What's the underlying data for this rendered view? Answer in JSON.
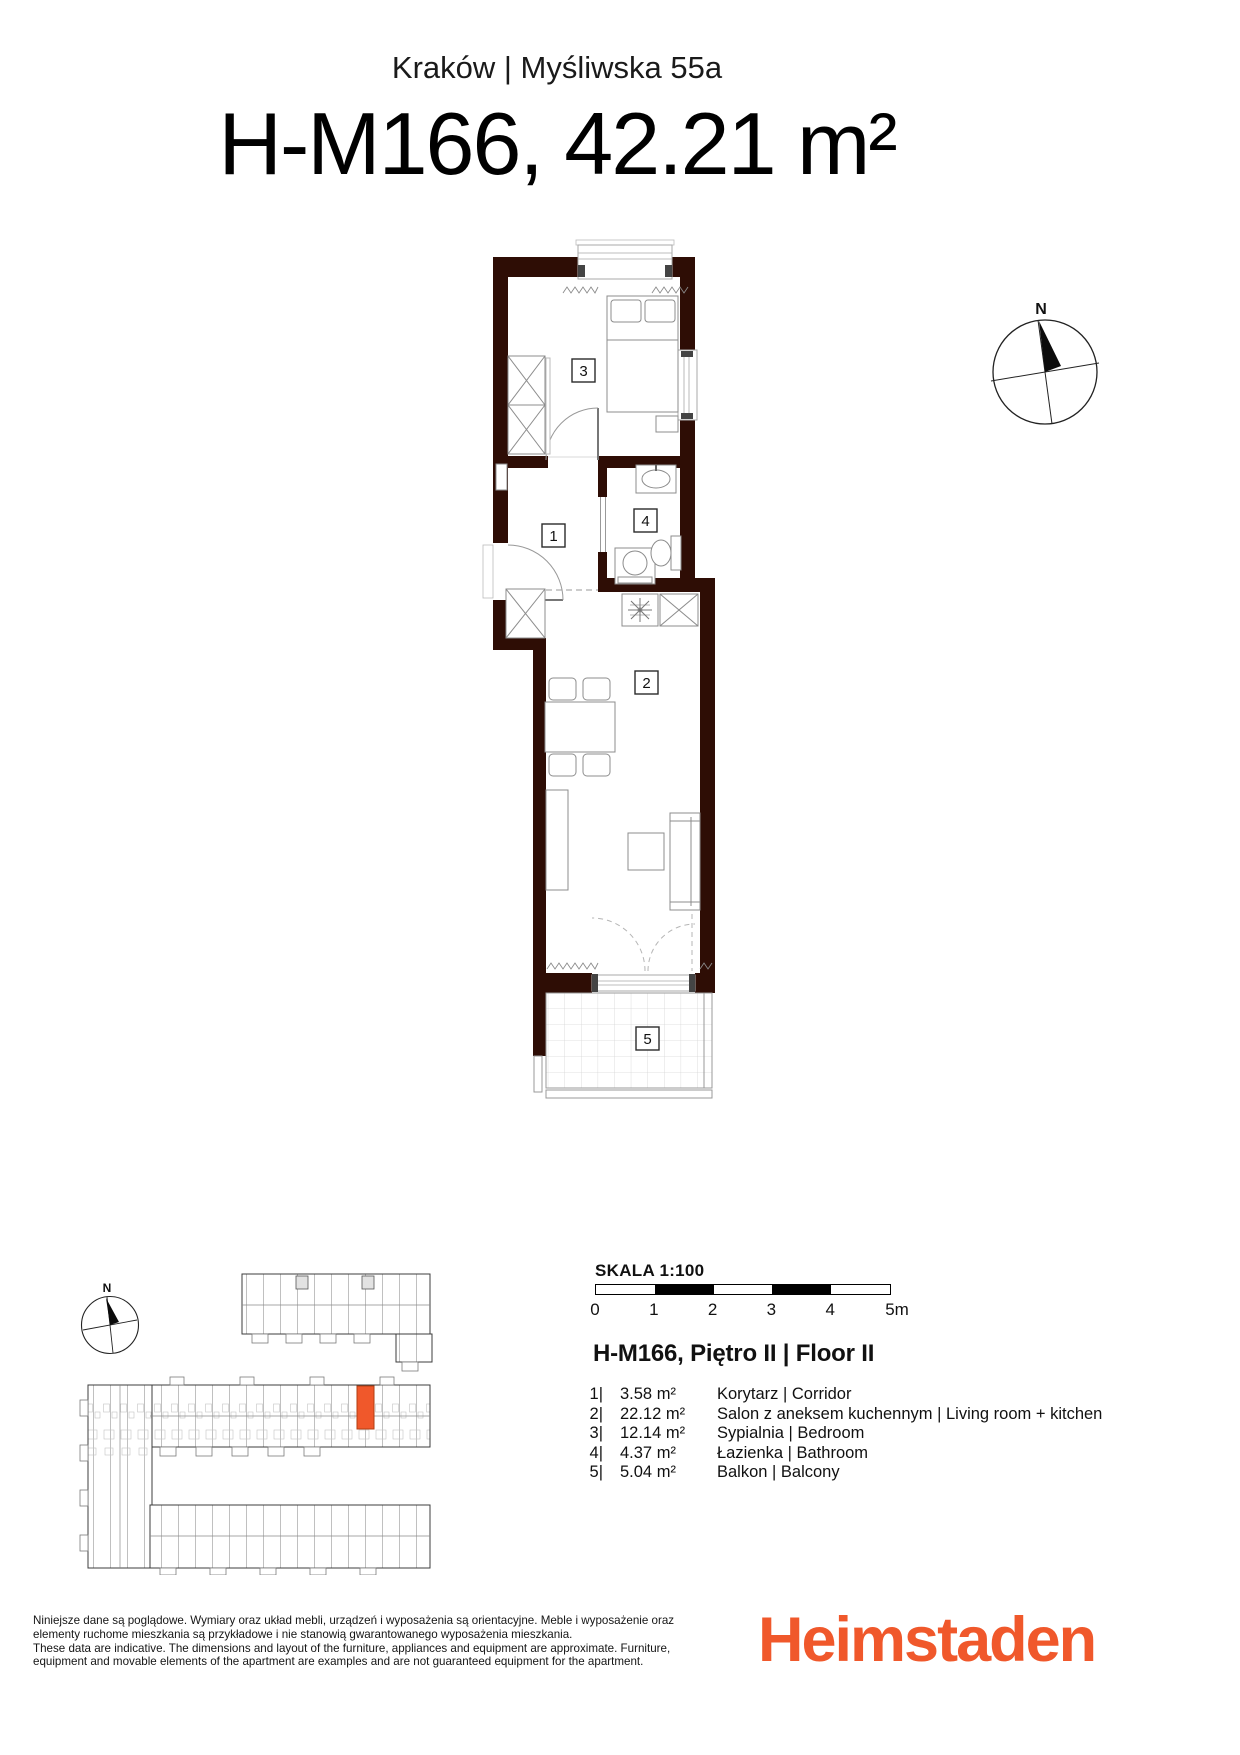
{
  "header": {
    "location": "Kraków | Myśliwska 55a",
    "title": "H-M166, 42.21 m²"
  },
  "plan": {
    "compass_north": "N",
    "labels": {
      "corridor": "1",
      "living_room": "2",
      "bedroom": "3",
      "bathroom": "4",
      "balcony": "5"
    }
  },
  "site": {
    "compass_north": "N"
  },
  "scale": {
    "label": "SKALA 1:100",
    "ticks": [
      "0",
      "1",
      "2",
      "3",
      "4",
      "5m"
    ]
  },
  "legend": {
    "title": "H-M166, Piętro II | Floor II",
    "rooms": [
      {
        "num": "1|",
        "area": "3.58 m²",
        "name": "Korytarz  | Corridor"
      },
      {
        "num": "2|",
        "area": "22.12 m²",
        "name": "Salon z aneksem kuchennym  | Living room + kitchen"
      },
      {
        "num": "3|",
        "area": "12.14 m²",
        "name": "Sypialnia | Bedroom"
      },
      {
        "num": "4|",
        "area": "4.37 m²",
        "name": "Łazienka  | Bathroom"
      },
      {
        "num": "5|",
        "area": "5.04 m²",
        "name": "Balkon | Balcony"
      }
    ]
  },
  "footer": {
    "disclaimer_lines": [
      "Niniejsze dane są poglądowe. Wymiary oraz układ mebli, urządzeń i wyposażenia są orientacyjne. Meble i wyposażenie oraz",
      "elementy ruchome mieszkania są przykładowe i nie stanowią gwarantowanego wyposażenia mieszkania.",
      "These data are indicative. The dimensions and layout of the furniture, appliances and equipment are approximate. Furniture,",
      "equipment and movable elements of the apartment are examples and are not guaranteed equipment for the apartment."
    ],
    "brand": "Heimstaden"
  },
  "colors": {
    "wall": "#2E0D05",
    "accent": "#F0582B"
  }
}
